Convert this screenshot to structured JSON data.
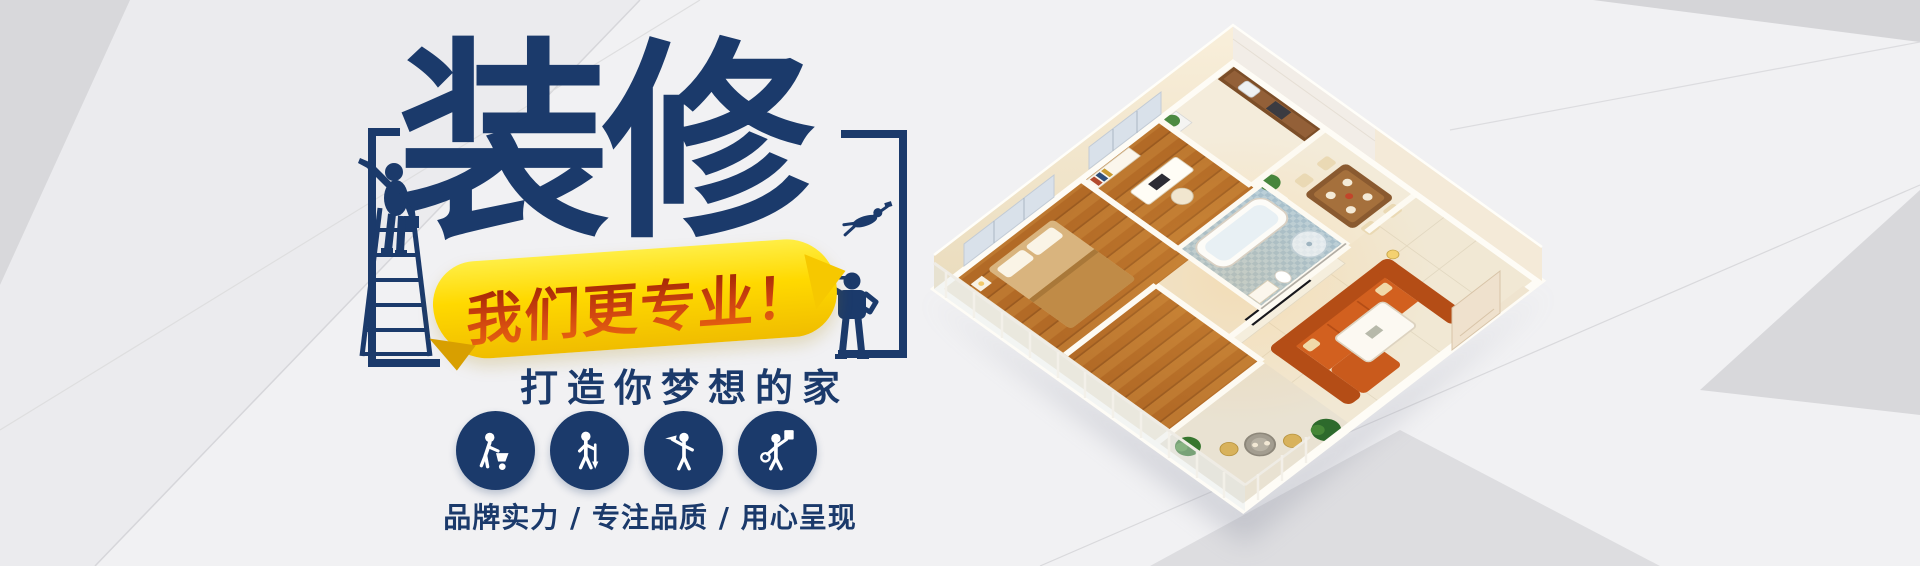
{
  "banner": {
    "title": "装修",
    "ribbon": "我们更专业！",
    "subtitle": "打造你梦想的家",
    "tagline": "品牌实力 / 专注品质 / 用心呈现"
  },
  "icons": [
    {
      "name": "worker-wheelbarrow-icon"
    },
    {
      "name": "worker-shovel-icon"
    },
    {
      "name": "worker-pickaxe-icon"
    },
    {
      "name": "worker-paint-bucket-icon"
    }
  ],
  "colors": {
    "navy": "#1b3a6b",
    "ribbon_yellow": "#ffd900",
    "ribbon_text_red": "#b32a00",
    "background": "#f1f1f3",
    "wood_floor": "#b56e29",
    "sofa_orange": "#c95a1c",
    "bath_blue": "#aecde2"
  }
}
